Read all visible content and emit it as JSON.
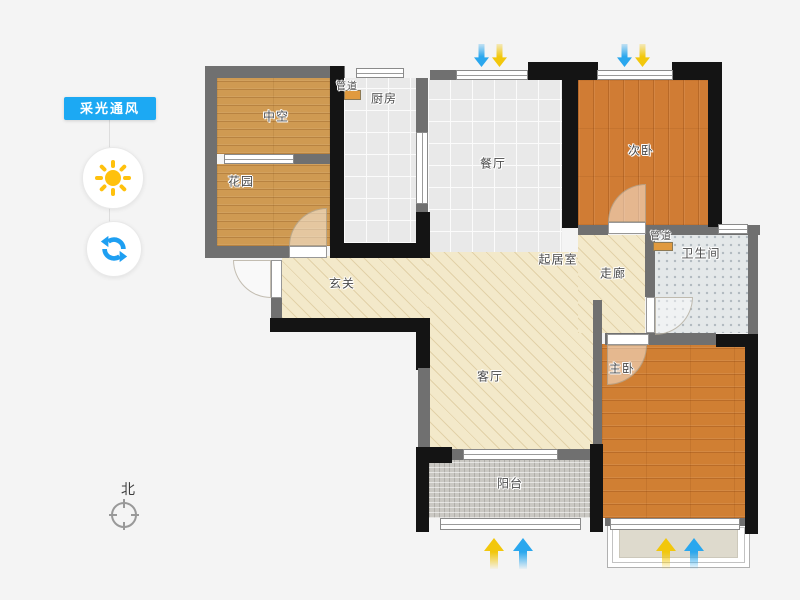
{
  "sidebar": {
    "panel_label": "采光通风",
    "panel_color": "#1ca9f3",
    "sun_icon_color": "#ffc10d",
    "refresh_icon_color": "#1e9ff2"
  },
  "compass": {
    "north_label": "北"
  },
  "floorplan": {
    "labels": {
      "zhongkong": "中空",
      "huayuan": "花园",
      "guandao_kitchen": "管道",
      "chufang": "厨房",
      "canting": "餐厅",
      "ciwo": "次卧",
      "guandao_bath": "管道",
      "weishengjian": "卫生间",
      "zoulang": "走廊",
      "qijushi": "起居室",
      "xuanguan": "玄关",
      "keting": "客厅",
      "zhuwo": "主卧",
      "yangtai": "阳台"
    },
    "arrows": {
      "blue": "#2aa7ee",
      "yellow": "#f2c70c",
      "top_direction": "down",
      "bottom_direction": "up"
    },
    "colors": {
      "wall_black": "#141414",
      "wall_gray": "#707070",
      "wood_light": "#cf9a52",
      "wood": "#d07c34",
      "tile": "#e9e9e9",
      "mosaic": "#e4e8e9",
      "hatch": "#f3e9ca",
      "balcony": "#cac8c3",
      "bay_fill": "#dedacd"
    }
  }
}
